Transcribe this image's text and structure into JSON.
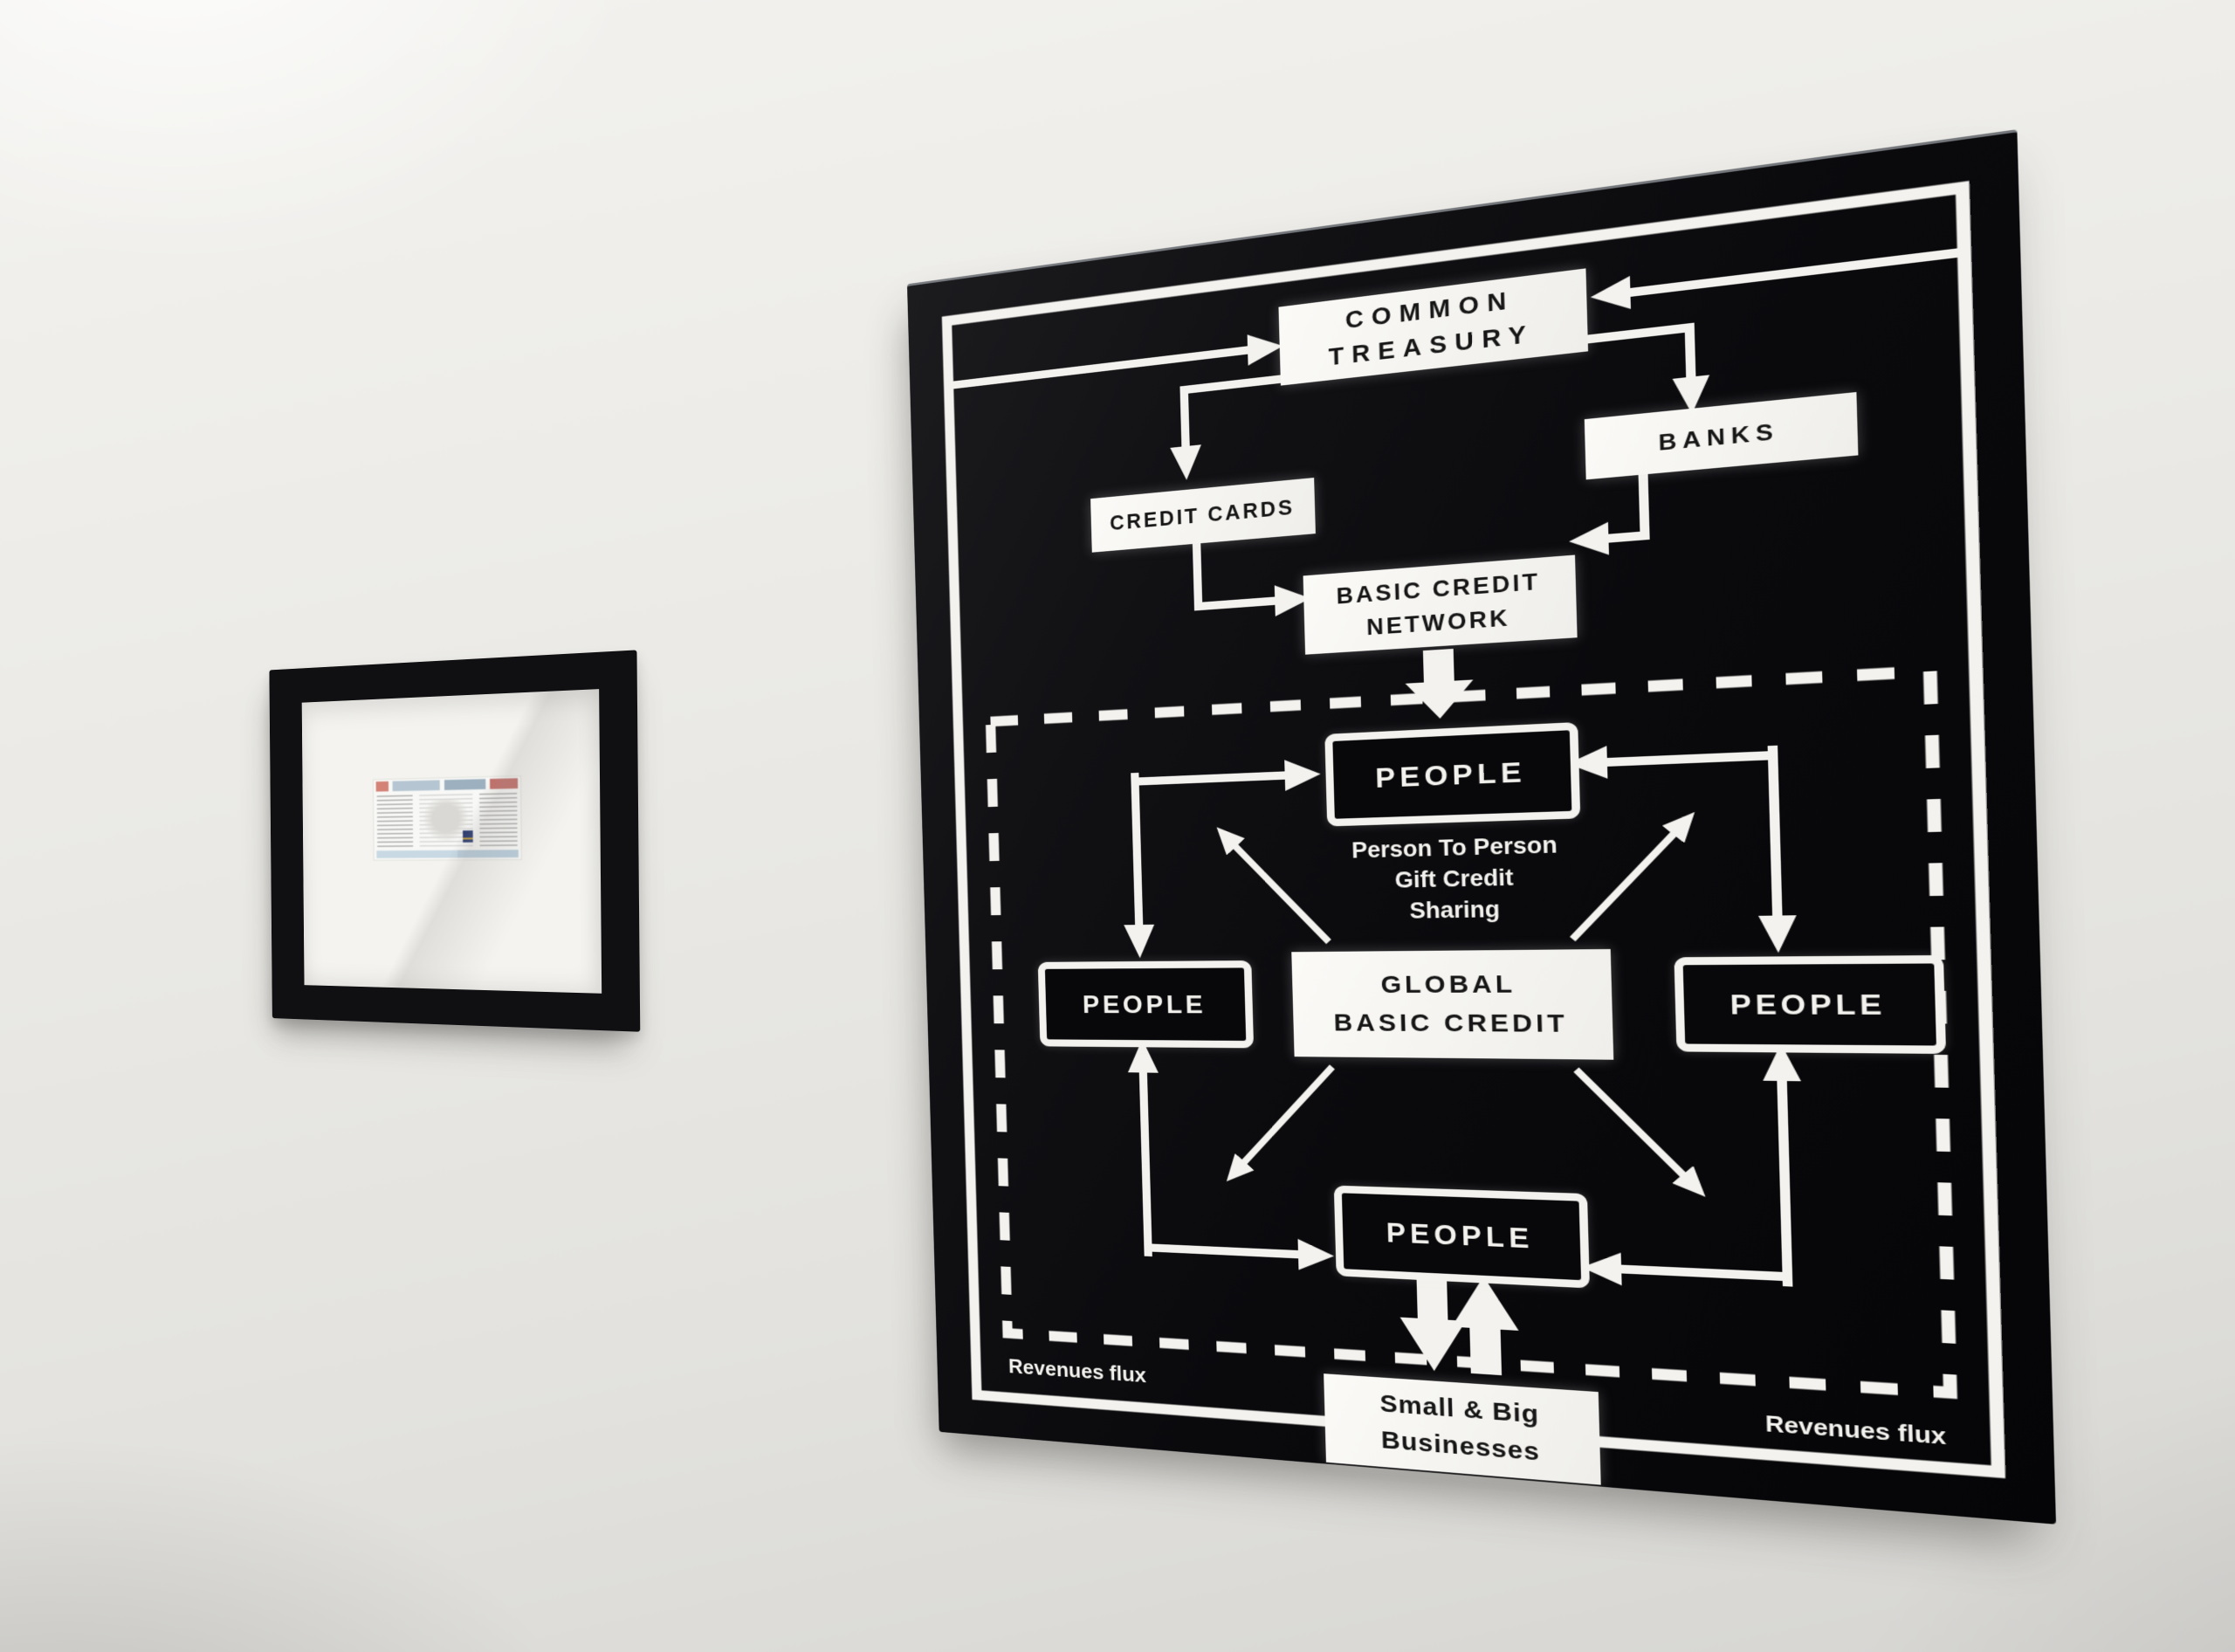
{
  "small_frame": {
    "content": "newspaper-clipping"
  },
  "diagram": {
    "nodes": {
      "common_treasury": "COMMON\nTREASURY",
      "banks": "BANKS",
      "credit_cards": "CREDIT CARDS",
      "basic_credit_network": "BASIC CREDIT\nNETWORK",
      "people": "PEOPLE",
      "global_basic_credit": "GLOBAL\nBASIC CREDIT",
      "small_big_businesses": "Small & Big\nBusinesses"
    },
    "notes": {
      "person_to_person": "Person To Person\nGift Credit\nSharing",
      "revenues_flux_left": "Revenues flux",
      "revenues_flux_right": "Revenues flux"
    },
    "colors": {
      "wall": "#e9e8e4",
      "panel_black": "#0a0a0d",
      "diagram_white": "#f3f2ee",
      "box_text": "#161616",
      "frame_black": "#101013"
    }
  }
}
